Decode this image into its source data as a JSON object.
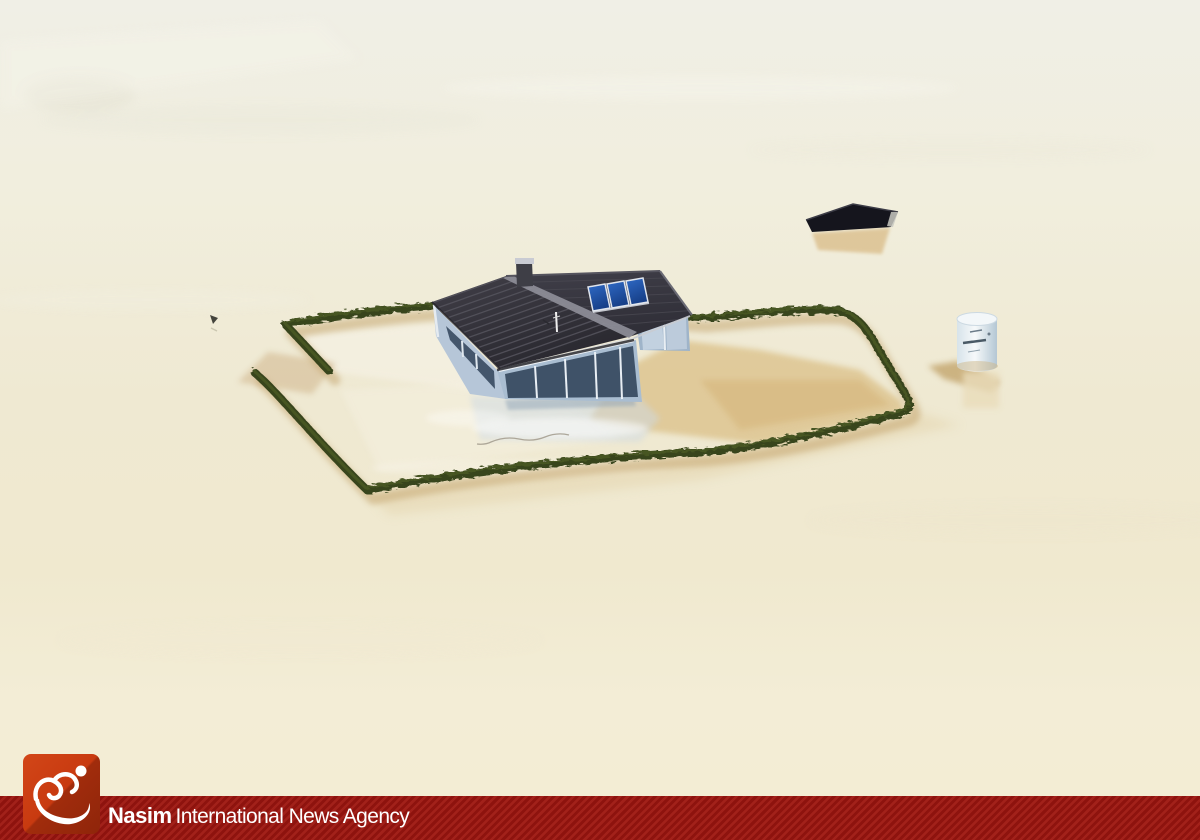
{
  "footer": {
    "brand": "Nasim",
    "agency_text": "International News Agency"
  },
  "scene": {
    "alt": "Aerial photograph of a flooded area: a house with a dark tiled roof and three blue solar panels stands submerged in beige floodwater, enclosed by a rectangular green hedge; a nearly submerged dark barn roof and a white feed silo protrude from the water nearby; a small bird floats at left",
    "colors": {
      "water_top": "#f0efe6",
      "water_bottom": "#f3edd4",
      "hedge": "#38441d",
      "hedge_highlight": "#5a6c2b",
      "shadow_tan": "#c2a26a",
      "roof": "#312f37",
      "dark_roof": "#15151d",
      "solar_panel": "#2457ad",
      "wall": "#b6c6d8",
      "band_red": "#8e130e",
      "band_stripe": "#a2211a",
      "logo_orange": "#c83a10"
    }
  }
}
